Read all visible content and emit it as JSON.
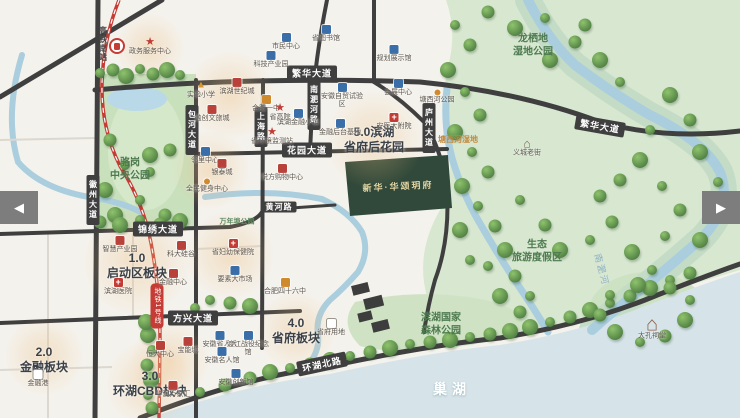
{
  "carousel": {
    "prev_arrow": "◀",
    "next_arrow": "▶"
  },
  "lake": {
    "name": "巢湖"
  },
  "project": {
    "name": "新华·华颂玥府",
    "plot_color": "#31493a"
  },
  "transit": {
    "station": "高铁南站",
    "line_badge": "地铁1号线",
    "line_color": "#c43c35"
  },
  "plates": [
    {
      "num": "1.0",
      "name": "启动区板块",
      "x": 137,
      "y": 266
    },
    {
      "num": "2.0",
      "name": "金融板块",
      "x": 44,
      "y": 360
    },
    {
      "num": "3.0",
      "name": "环湖CBD板块",
      "x": 150,
      "y": 384
    },
    {
      "num": "4.0",
      "name": "省府板块",
      "x": 296,
      "y": 331
    },
    {
      "num": "5.0滨湖",
      "name": "省府后花园",
      "x": 374,
      "y": 140
    }
  ],
  "road_labels": [
    {
      "text": "繁华大道",
      "x": 312,
      "y": 73
    },
    {
      "text": "繁华大道",
      "x": 600,
      "y": 126,
      "rot": 10
    },
    {
      "text": "花园大道",
      "x": 307,
      "y": 150
    },
    {
      "text": "黄河路",
      "x": 279,
      "y": 207,
      "sm": true
    },
    {
      "text": "锦绣大道",
      "x": 158,
      "y": 229
    },
    {
      "text": "方兴大道",
      "x": 193,
      "y": 318
    },
    {
      "text": "环湖北路",
      "x": 322,
      "y": 364,
      "rot": -12
    },
    {
      "text": "徽州大道",
      "x": 93,
      "y": 200,
      "v": true
    },
    {
      "text": "包河大道",
      "x": 192,
      "y": 130,
      "v": true
    },
    {
      "text": "上海路",
      "x": 261,
      "y": 127,
      "v": true
    },
    {
      "text": "南淝河路",
      "x": 314,
      "y": 105,
      "v": true
    },
    {
      "text": "庐州大道",
      "x": 429,
      "y": 128,
      "v": true
    }
  ],
  "area_labels": [
    {
      "lines": [
        "骆岗",
        "中央公园"
      ],
      "x": 130,
      "y": 170,
      "cls": "park"
    },
    {
      "lines": [
        "龙栖地",
        "湿地公园"
      ],
      "x": 533,
      "y": 46,
      "cls": "park"
    },
    {
      "lines": [
        "生态",
        "旅游度假区"
      ],
      "x": 537,
      "y": 252,
      "cls": "park"
    },
    {
      "lines": [
        "滨湖国家",
        "森林公园"
      ],
      "x": 441,
      "y": 325,
      "cls": "park"
    },
    {
      "lines": [
        "塘西河湿地"
      ],
      "x": 458,
      "y": 140,
      "cls": "wet"
    },
    {
      "lines": [
        "万年埠公园"
      ],
      "x": 237,
      "y": 223,
      "cls": "park-sm"
    },
    {
      "lines": [
        "南淝河"
      ],
      "x": 601,
      "y": 270,
      "cls": "river",
      "rot": 75
    }
  ],
  "markers": [
    {
      "t": "star",
      "x": 150,
      "y": 46,
      "l": "政务服务中心"
    },
    {
      "t": "blue",
      "x": 286,
      "y": 42,
      "l": "市民中心"
    },
    {
      "t": "blue",
      "x": 326,
      "y": 34,
      "l": "省图书馆"
    },
    {
      "t": "blue",
      "x": 394,
      "y": 54,
      "l": "规划展示馆"
    },
    {
      "t": "blue",
      "x": 271,
      "y": 60,
      "l": "科技产业园"
    },
    {
      "t": "school",
      "x": 201,
      "y": 89,
      "l": "实验小学"
    },
    {
      "t": "red",
      "x": 237,
      "y": 87,
      "l": "滨湖世纪城"
    },
    {
      "t": "red",
      "x": 212,
      "y": 114,
      "l": "融创文旅城"
    },
    {
      "t": "orange",
      "x": 266,
      "y": 104,
      "l": "合肥一中"
    },
    {
      "t": "star",
      "x": 280,
      "y": 112,
      "l": "省高院"
    },
    {
      "t": "blue",
      "x": 298,
      "y": 118,
      "l": "滨湖金融小镇"
    },
    {
      "t": "star",
      "x": 272,
      "y": 136,
      "l": "省环境监测站"
    },
    {
      "t": "blue",
      "x": 342,
      "y": 96,
      "l": "安徽自贸试验区"
    },
    {
      "t": "blue",
      "x": 340,
      "y": 128,
      "l": "金融后台基地"
    },
    {
      "t": "hosp",
      "x": 394,
      "y": 122,
      "l": "安医大附院"
    },
    {
      "t": "blue",
      "x": 398,
      "y": 88,
      "l": "会展中心"
    },
    {
      "t": "blue",
      "x": 205,
      "y": 156,
      "l": "邻里中心"
    },
    {
      "t": "red",
      "x": 222,
      "y": 168,
      "l": "银泰城"
    },
    {
      "t": "dot",
      "x": 207,
      "y": 186,
      "l": "全民健身中心"
    },
    {
      "t": "red",
      "x": 282,
      "y": 173,
      "l": "悦方购物中心"
    },
    {
      "t": "red",
      "x": 120,
      "y": 245,
      "l": "智慧产业园"
    },
    {
      "t": "red",
      "x": 181,
      "y": 250,
      "l": "科大硅谷"
    },
    {
      "t": "hosp",
      "x": 233,
      "y": 248,
      "l": "省妇幼保健院"
    },
    {
      "t": "blue",
      "x": 235,
      "y": 275,
      "l": "要素大市场"
    },
    {
      "t": "red",
      "x": 173,
      "y": 278,
      "l": "金融中心"
    },
    {
      "t": "hosp",
      "x": 118,
      "y": 287,
      "l": "滨湖医院"
    },
    {
      "t": "orange",
      "x": 285,
      "y": 287,
      "l": "合肥四十六中"
    },
    {
      "t": "white",
      "x": 331,
      "y": 328,
      "l": "省府用地"
    },
    {
      "t": "blue",
      "x": 220,
      "y": 340,
      "l": "安徽省人大"
    },
    {
      "t": "blue",
      "x": 248,
      "y": 344,
      "l": "渡江战役纪念馆"
    },
    {
      "t": "blue",
      "x": 222,
      "y": 356,
      "l": "安徽名人馆"
    },
    {
      "t": "blue",
      "x": 236,
      "y": 378,
      "l": "安徽创新馆"
    },
    {
      "t": "red",
      "x": 188,
      "y": 346,
      "l": "宝能城"
    },
    {
      "t": "red",
      "x": 160,
      "y": 350,
      "l": "恒大中心"
    },
    {
      "t": "red",
      "x": 173,
      "y": 390,
      "l": "华润万象汇"
    },
    {
      "t": "white",
      "x": 38,
      "y": 379,
      "l": "金融港"
    },
    {
      "t": "dot",
      "x": 437,
      "y": 97,
      "l": "塘西河公园"
    },
    {
      "t": "house",
      "x": 527,
      "y": 148,
      "l": "义城老街"
    },
    {
      "t": "temple",
      "x": 652,
      "y": 330,
      "l": "大孔祠堂"
    }
  ]
}
